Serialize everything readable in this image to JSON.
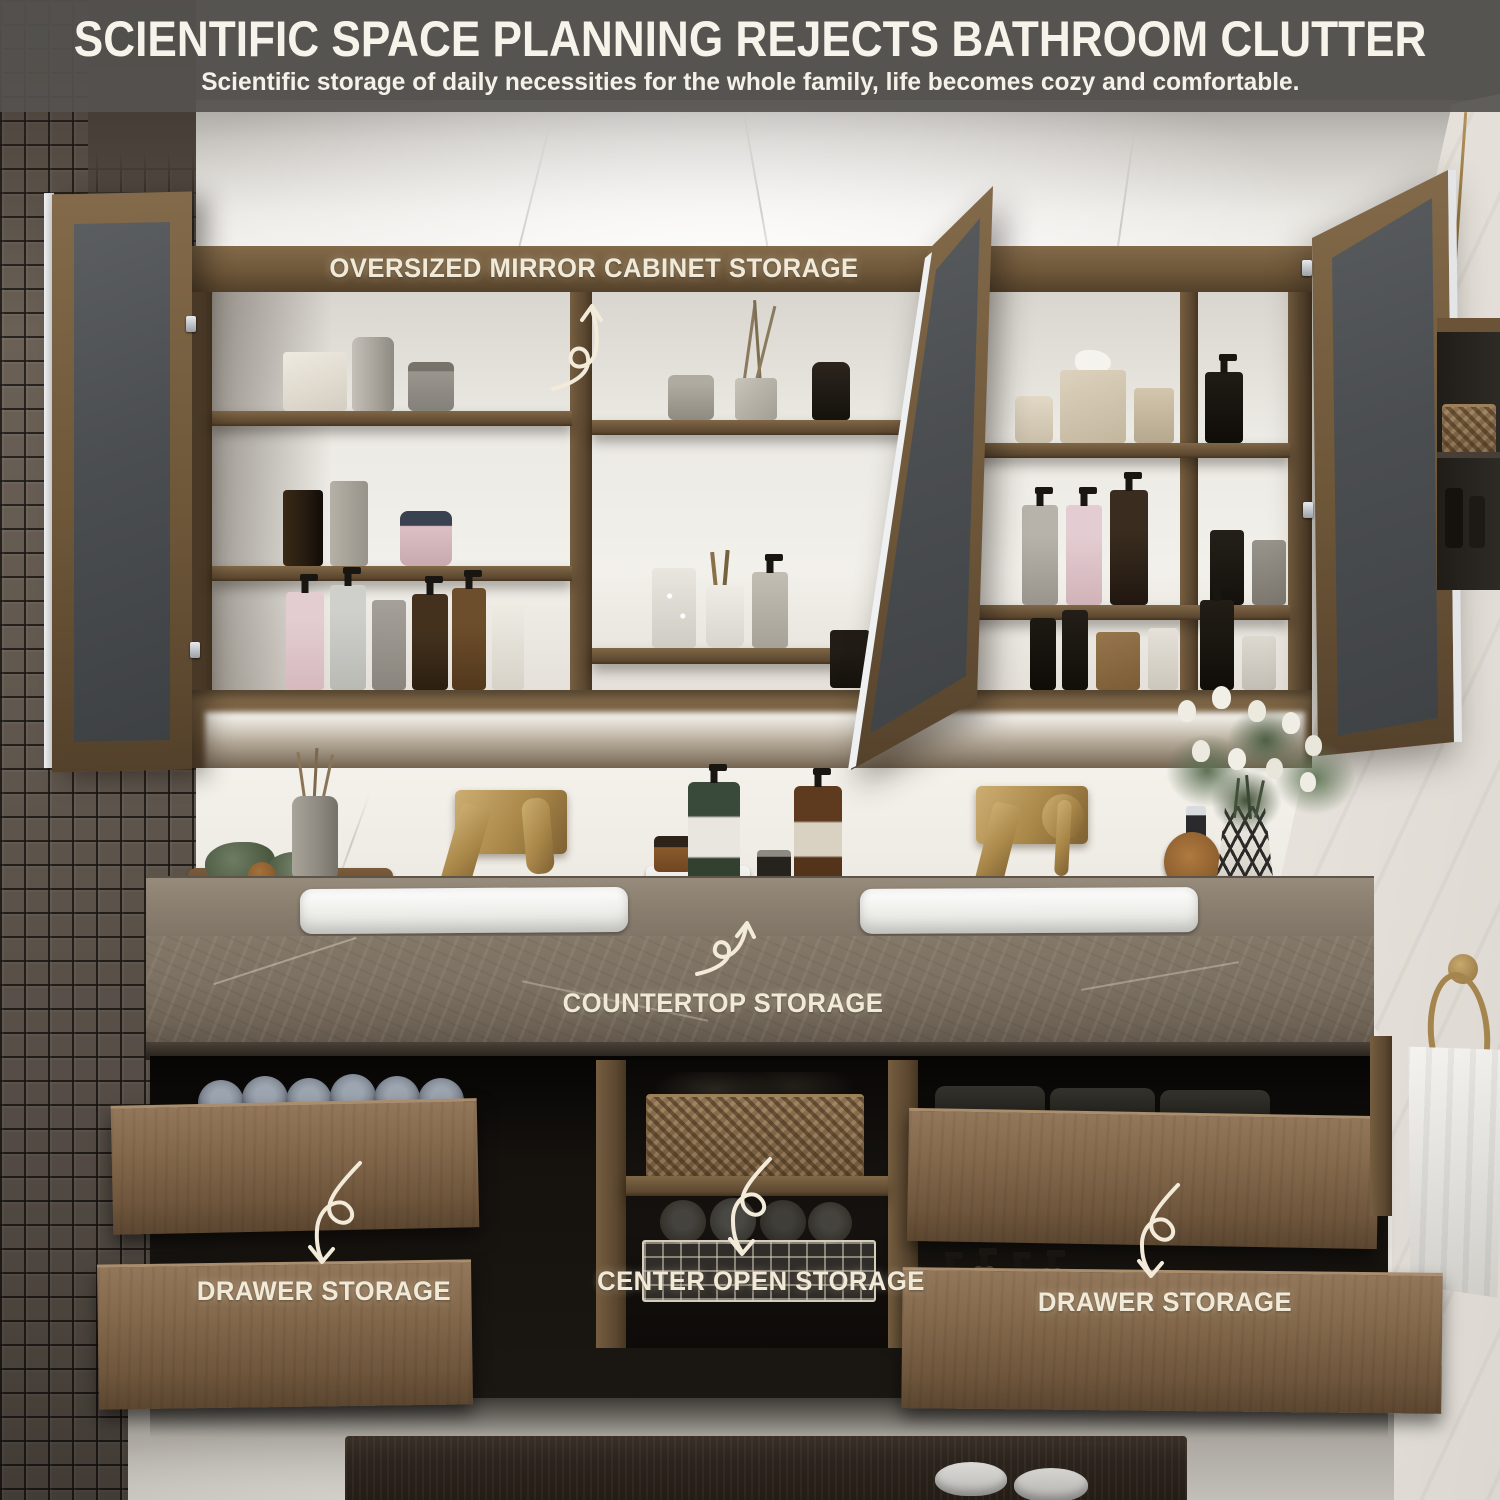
{
  "header": {
    "title": "SCIENTIFIC SPACE PLANNING REJECTS BATHROOM CLUTTER",
    "subtitle": "Scientific storage of daily necessities for the whole family, life becomes cozy and comfortable."
  },
  "annotations": {
    "mirror_cabinet": "OVERSIZED MIRROR CABINET STORAGE",
    "countertop": "COUNTERTOP STORAGE",
    "left_drawer": "DRAWER STORAGE",
    "center_open": "CENTER OPEN STORAGE",
    "right_drawer": "DRAWER STORAGE"
  },
  "colors": {
    "header_overlay": "#555350",
    "label_text": "#F2EAD8",
    "cabinet_wood": "#6E5739",
    "vanity_wood": "#84694C",
    "brass": "#A98749",
    "countertop_stone": "#7B7062",
    "mirror_glass": "#4B4E51"
  }
}
